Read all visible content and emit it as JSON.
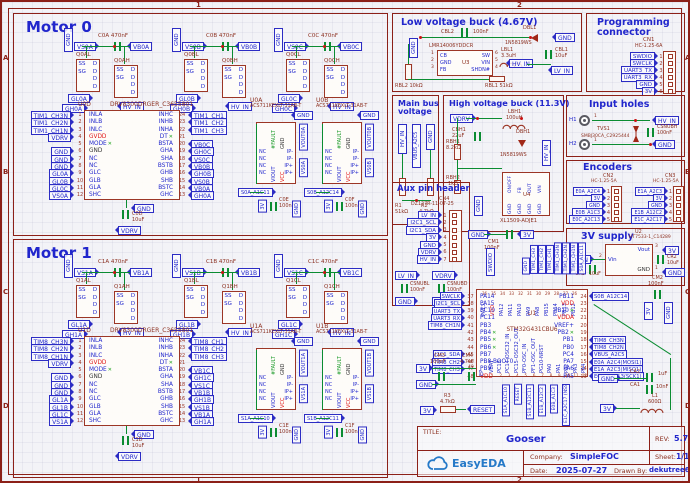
{
  "frame": {
    "rows": [
      "A",
      "B",
      "C",
      "D"
    ],
    "cols": [
      "1",
      "2"
    ]
  },
  "colors": {
    "accent_blue": "#2126cc",
    "outline_maroon": "#9c3626",
    "wire_green": "#0b8c32",
    "power_red": "#e01818",
    "logo_blue": "#2579c8"
  },
  "motor0": {
    "title": "Motor 0",
    "phases": [
      {
        "gnd": "GND",
        "vs": "VS0A",
        "cap": "C0A",
        "val": "470nF",
        "vb": "VB0A",
        "ql": "Q0AL",
        "qh": "Q0AH",
        "s": "SSSG",
        "d": "DDDD",
        "gl": "GL0A",
        "gh": "GH0A",
        "hv": "HV_IN"
      },
      {
        "gnd": "GND",
        "vs": "VS0B",
        "cap": "C0B",
        "val": "470nF",
        "vb": "VB0B",
        "ql": "Q0BL",
        "qh": "Q0BH",
        "s": "SSSG",
        "d": "DDDD",
        "gl": "GL0B",
        "gh": "GH0B",
        "hv": "HV_IN"
      },
      {
        "gnd": "GND",
        "vs": "VS0C",
        "cap": "C0C",
        "val": "470nF",
        "vb": "VB0C",
        "ql": "Q0CL",
        "qh": "Q0CH",
        "s": "SSSG",
        "d": "DDDD",
        "gl": "GL0C",
        "gh": "GH0C",
        "hv": "HV_IN"
      }
    ],
    "driver": {
      "ref": "U0D",
      "part": "DRV8300DRGER_C3655801",
      "gnd": "GND",
      "cap": "C0D",
      "capv": "10uF",
      "vdrv": "VDRV",
      "rows": [
        {
          "ln": "TIM1_CH3N",
          "lp": "1",
          "lpin": "INLA",
          "rpin": "INHC",
          "rp": "24",
          "rn": "TIM1_CH1"
        },
        {
          "ln": "TIM1_CH2N",
          "lp": "2",
          "lpin": "INLB",
          "rpin": "INHB",
          "rp": "23",
          "rn": "TIM1_CH2"
        },
        {
          "ln": "TIM1_CH1N",
          "lp": "3",
          "lpin": "INLC",
          "rpin": "INHA",
          "rp": "22",
          "rn": "TIM1_CH3"
        },
        {
          "ln": "VDRV",
          "lp": "4",
          "lpin": "GVDD",
          "lcls": "red",
          "rpin": "DT",
          "rp": "21",
          "rn": "",
          "rcls": "xm"
        },
        {
          "ln": "",
          "lp": "5",
          "lpin": "MODE",
          "lcls": "xm",
          "rpin": "BSTA",
          "rp": "20",
          "rn": "VB0C"
        },
        {
          "ln": "GND",
          "lp": "6",
          "lpin": "GND",
          "lcls": "dark",
          "rpin": "GHA",
          "rp": "19",
          "rn": "GH0C"
        },
        {
          "ln": "GND",
          "lp": "7",
          "lpin": "NC",
          "rpin": "SHA",
          "rp": "18",
          "rn": "VS0C"
        },
        {
          "ln": "GND",
          "lp": "8",
          "lpin": "NC",
          "rpin": "BSTB",
          "rp": "17",
          "rn": "VB0B"
        },
        {
          "ln": "GL0A",
          "lp": "9",
          "lpin": "GLC",
          "rpin": "GHB",
          "rp": "16",
          "rn": "GH0B"
        },
        {
          "ln": "GL0B",
          "lp": "10",
          "lpin": "GLB",
          "rpin": "SHB",
          "rp": "15",
          "rn": "VS0B"
        },
        {
          "ln": "GL0C",
          "lp": "11",
          "lpin": "GLA",
          "rpin": "BSTC",
          "rp": "14",
          "rn": "VB0A"
        },
        {
          "ln": "VS0A",
          "lp": "12",
          "lpin": "SHC",
          "rpin": "GHC",
          "rp": "13",
          "rn": "GH0A"
        }
      ]
    },
    "sensors": [
      {
        "ref": "U0A",
        "part": "ACS711KEXLT-31AB-T",
        "gnd": "GND",
        "fault": "#FAULT",
        "gndpin": "GND",
        "vout": "VOUT0A",
        "nc": [
          "NC",
          "NC",
          "NC",
          "NC"
        ],
        "ip": [
          "IP-",
          "IP-",
          "IP+",
          "IP+"
        ],
        "vs": "VS0A",
        "viout": "VIOUT",
        "vcc": "VCC",
        "snet": "S0A_A1C11",
        "cap": "C0E",
        "capv": "100nF",
        "v3": "3V",
        "gnd2": "GND"
      },
      {
        "ref": "U0B",
        "part": "ACS711KEXLT-31AB-T",
        "gnd": "GND",
        "fault": "#FAULT",
        "gndpin": "GND",
        "vout": "VOUT0B",
        "nc": [
          "NC",
          "NC",
          "NC",
          "NC"
        ],
        "ip": [
          "IP-",
          "IP-",
          "IP+",
          "IP+"
        ],
        "vs": "VS0B",
        "viout": "VIOUT",
        "vcc": "VCC",
        "snet": "S0B_A12C14",
        "cap": "C0F",
        "capv": "100nF",
        "v3": "3V",
        "gnd2": "GND"
      }
    ]
  },
  "motor1": {
    "title": "Motor 1",
    "phases": [
      {
        "gnd": "GND",
        "vs": "VS1A",
        "cap": "C1A",
        "val": "470nF",
        "vb": "VB1A",
        "ql": "Q1AL",
        "qh": "Q1AH",
        "s": "SSSG",
        "d": "DDDD",
        "gl": "GL1A",
        "gh": "GH1A",
        "hv": "HV_IN"
      },
      {
        "gnd": "GND",
        "vs": "VS1B",
        "cap": "C1B",
        "val": "470nF",
        "vb": "VB1B",
        "ql": "Q1BL",
        "qh": "Q1BH",
        "s": "SSSG",
        "d": "DDDD",
        "gl": "GL1B",
        "gh": "GH1B",
        "hv": "HV_IN"
      },
      {
        "gnd": "GND",
        "vs": "VS1C",
        "cap": "C1C",
        "val": "470nF",
        "vb": "VB1C",
        "ql": "Q1CL",
        "qh": "Q1CH",
        "s": "SSSG",
        "d": "DDDD",
        "gl": "GL1C",
        "gh": "GH1C",
        "hv": "HV_IN"
      }
    ],
    "driver": {
      "ref": "U1D",
      "part": "DRV8300DRGER_C3655801",
      "gnd": "GND",
      "cap": "C1D",
      "capv": "10uF",
      "vdrv": "VDRV",
      "rows": [
        {
          "ln": "TIM8_CH3N",
          "lp": "1",
          "lpin": "INLA",
          "rpin": "INHC",
          "rp": "24",
          "rn": "TIM8_CH1"
        },
        {
          "ln": "TIM8_CH2N",
          "lp": "2",
          "lpin": "INLB",
          "rpin": "INHB",
          "rp": "23",
          "rn": "TIM8_CH2"
        },
        {
          "ln": "TIM8_CH1N",
          "lp": "3",
          "lpin": "INLC",
          "rpin": "INHA",
          "rp": "22",
          "rn": "TIM8_CH3"
        },
        {
          "ln": "VDRV",
          "lp": "4",
          "lpin": "GVDD",
          "lcls": "red",
          "rpin": "DT",
          "rp": "21",
          "rn": "",
          "rcls": "xm"
        },
        {
          "ln": "",
          "lp": "5",
          "lpin": "MODE",
          "lcls": "xm",
          "rpin": "BSTA",
          "rp": "20",
          "rn": "VB1C"
        },
        {
          "ln": "GND",
          "lp": "6",
          "lpin": "GND",
          "lcls": "dark",
          "rpin": "GHA",
          "rp": "19",
          "rn": "GH1C"
        },
        {
          "ln": "GND",
          "lp": "7",
          "lpin": "NC",
          "rpin": "SHA",
          "rp": "18",
          "rn": "VS1C"
        },
        {
          "ln": "GND",
          "lp": "8",
          "lpin": "NC",
          "rpin": "BSTB",
          "rp": "17",
          "rn": "VB1B"
        },
        {
          "ln": "GL1A",
          "lp": "9",
          "lpin": "GLC",
          "rpin": "GHB",
          "rp": "16",
          "rn": "GH1B"
        },
        {
          "ln": "GL1B",
          "lp": "10",
          "lpin": "GLB",
          "rpin": "SHB",
          "rp": "15",
          "rn": "VS1B"
        },
        {
          "ln": "GL1C",
          "lp": "11",
          "lpin": "GLA",
          "rpin": "BSTC",
          "rp": "14",
          "rn": "VB1A"
        },
        {
          "ln": "VS1A",
          "lp": "12",
          "lpin": "SHC",
          "rpin": "GHC",
          "rp": "13",
          "rn": "GH1A"
        }
      ]
    },
    "sensors": [
      {
        "ref": "U1A",
        "part": "ACS711KEXLT-31AB-T",
        "gnd": "GND",
        "fault": "#FAULT",
        "gndpin": "GND",
        "vout": "VOUT1A",
        "nc": [
          "NC",
          "NC",
          "NC",
          "NC"
        ],
        "ip": [
          "IP-",
          "IP-",
          "IP+",
          "IP+"
        ],
        "vs": "VS1A",
        "viout": "VIOUT",
        "vcc": "VCC",
        "snet": "S1A_A1C10",
        "cap": "C1E",
        "capv": "100nF",
        "v3": "3V",
        "gnd2": "GND"
      },
      {
        "ref": "U1B",
        "part": "ACS711KEXLT-31AB-T",
        "gnd": "GND",
        "fault": "#FAULT",
        "gndpin": "GND",
        "vout": "VOUT1B",
        "nc": [
          "NC",
          "NC",
          "NC",
          "NC"
        ],
        "ip": [
          "IP-",
          "IP-",
          "IP+",
          "IP+"
        ],
        "vs": "VS1B",
        "viout": "VIOUT",
        "vcc": "VCC",
        "snet": "S1B_A12C11",
        "cap": "C1F",
        "capv": "100nF",
        "v3": "3V",
        "gnd2": "GND"
      }
    ]
  },
  "low_buck": {
    "title": "Low voltage buck (4.67V)",
    "gnd_l": "GND",
    "c2": {
      "ref": "CBL2",
      "val": "100nF"
    },
    "d1": {
      "ref": "DBL1",
      "val": "1N5819WS"
    },
    "gnd_r": "GND",
    "u": {
      "ref": "U3",
      "part": "LMR14006YDDCR",
      "lpins": [
        {
          "p": "1",
          "n": "CB"
        },
        {
          "p": "2",
          "n": "GND"
        },
        {
          "p": "3",
          "n": "FB"
        }
      ],
      "rpins": [
        {
          "n": "SW",
          "p": "6"
        },
        {
          "n": "VIN",
          "p": "5"
        },
        {
          "n": "SHDN#",
          "p": "4"
        }
      ]
    },
    "ind": {
      "ref": "LBL1",
      "val": "3.3uH"
    },
    "c1": {
      "ref": "CBL1",
      "val": "10uF"
    },
    "lv": "LV_IN",
    "hv": "HV_IN",
    "r1": {
      "ref": "RBL1",
      "val": "51kΩ"
    },
    "r2": {
      "ref": "RBL2",
      "val": "10kΩ"
    }
  },
  "prog": {
    "title1": "Programming",
    "title2": "connector",
    "ref": "CN1",
    "part": "HC-1.25-6A",
    "rows": [
      {
        "n": "SWDIO",
        "p": "1"
      },
      {
        "n": "SWCLK",
        "p": "2"
      },
      {
        "n": "UART3_TX",
        "p": "3"
      },
      {
        "n": "UART3_RX",
        "p": "4"
      },
      {
        "n": "GND",
        "p": "5"
      },
      {
        "n": "3V",
        "p": "6"
      }
    ]
  },
  "main_bus": {
    "title1": "Main bus",
    "title2": "voltage",
    "flags": [
      "HV_IN",
      "VBUS_A2C5",
      "GND"
    ],
    "r1": {
      "ref": "R1",
      "val": "51kΩ"
    },
    "r2": {
      "ref": "R2",
      "val": "4.7kΩ"
    }
  },
  "hv_buck": {
    "title": "High voltage buck (11.3V)",
    "vdrv": "VDRV",
    "ind": {
      "ref": "LBH1",
      "val": "100uH"
    },
    "cb": {
      "ref": "CBH1",
      "val": "22uF"
    },
    "d": {
      "ref": "DBH1",
      "val": "1N5819WS"
    },
    "r1": {
      "ref": "RBH1",
      "val": "8.2kΩ"
    },
    "r2": {
      "ref": "RBH2",
      "val": "1kΩ"
    },
    "hv": "HV_IN",
    "gnd": "GND",
    "u": {
      "ref": "U4",
      "part": "XL1509-ADJE1",
      "top": [
        "ON/OFF",
        "FB",
        "OUT",
        "VIN"
      ],
      "bot": [
        "GND",
        "GND",
        "GND",
        "GND"
      ]
    }
  },
  "input_holes": {
    "title": "Input holes",
    "h1": "H1",
    "h1p": "1",
    "h2": "H2",
    "h2p": "1",
    "tvs": {
      "ref": "TVS1",
      "part": "SMBJ30CA_C2925444"
    },
    "cap": {
      "ref": "CSNUBH",
      "val": "100nF"
    },
    "hv": "HV_IN",
    "gnd": "GND"
  },
  "encoders": {
    "title": "Encoders",
    "cn2": {
      "ref": "CN2",
      "part": "HC-1.25-5A",
      "rows": [
        {
          "n": "E0A_A2C4",
          "p": "1"
        },
        {
          "n": "3V",
          "p": "2"
        },
        {
          "n": "GND",
          "p": "3"
        },
        {
          "n": "E0B_A1C3",
          "p": "4"
        },
        {
          "n": "E0C_A2C13",
          "p": "5"
        }
      ]
    },
    "cn3": {
      "ref": "CN3",
      "part": "HC-1.25-5A",
      "rows": [
        {
          "n": "E1A_A2C3",
          "p": "1"
        },
        {
          "n": "3V",
          "p": "2"
        },
        {
          "n": "GND",
          "p": "3"
        },
        {
          "n": "E1B_A12C2",
          "p": "4"
        },
        {
          "n": "E1C_A2C17",
          "p": "5"
        }
      ]
    }
  },
  "aux": {
    "title": "Aux pin header",
    "ref": "CN4",
    "part": "DZ127R-11-07-25",
    "rows": [
      {
        "n": "LV_IN",
        "p": "1"
      },
      {
        "n": "I2C1_SCL",
        "p": "2"
      },
      {
        "n": "I2C1_SDA",
        "p": "3"
      },
      {
        "n": "3V",
        "p": "4"
      },
      {
        "n": "GND",
        "p": "5"
      },
      {
        "n": "VDRV",
        "p": "6"
      },
      {
        "n": "HV_IN",
        "p": "7"
      }
    ],
    "snubs": [
      {
        "net": "LV_IN",
        "ref": "CSNUBL",
        "val": "100nF",
        "gnd": "GND"
      },
      {
        "net": "VDRV",
        "ref": "CSNUBD",
        "val": "100nF",
        "gnd": "GND"
      }
    ]
  },
  "supply3v": {
    "title": "3V supply",
    "ref": "U2",
    "part": "HT7533-1_C14289",
    "vin": "Vin",
    "vin_p": "2",
    "vout": "Vout",
    "vout_p": "3",
    "gnd_pin": "GND",
    "gnd_p": "1",
    "lv": "LV_IN",
    "v3": "3V",
    "gnd": "GND",
    "cr1": {
      "ref": "CR1",
      "val": "10uF"
    },
    "cr2": {
      "ref": "CR2",
      "val": "10uF"
    }
  },
  "mcu": {
    "ref": "U1",
    "part": "STM32G431CBU6",
    "ep": "EP",
    "ep_num": "49",
    "swdio": "SWDIO",
    "decap": {
      "gnd": "GND",
      "ref": "CM1",
      "val": "100nF",
      "v3": "3V"
    },
    "top_nets": [
      "GND",
      "TIM1_CH3",
      "TIM1_CH2",
      "TIM1_CH1",
      "TIM1_CH3N",
      "TIM1_CH2N",
      "TIM1_CH1N",
      "S0A_A1C11"
    ],
    "top_pins": [
      {
        "pin": "PA13",
        "p": "36"
      },
      {
        "pin": "VDD",
        "p": "35",
        "cls": "red"
      },
      {
        "pin": "PA12",
        "p": "34"
      },
      {
        "pin": "PA11",
        "p": "33"
      },
      {
        "pin": "PA10",
        "p": "32"
      },
      {
        "pin": "PA9",
        "p": "31"
      },
      {
        "pin": "PA8",
        "p": "30"
      },
      {
        "pin": "PB15",
        "p": "29"
      },
      {
        "pin": "PB14",
        "p": "28"
      },
      {
        "pin": "PB13",
        "p": "27"
      },
      {
        "pin": "PB12",
        "p": "26"
      }
    ],
    "left": [
      {
        "ln": "SWCLK",
        "lp": "37",
        "pin": "PA14"
      },
      {
        "ln": "I2C1_SCL",
        "lp": "38",
        "pin": "PA15"
      },
      {
        "ln": "UART3_TX",
        "lp": "39",
        "pin": "PC10"
      },
      {
        "ln": "UART3_RX",
        "lp": "40",
        "pin": "PC11"
      },
      {
        "ln": "TIM8_CH1N",
        "lp": "41",
        "pin": "PB3"
      },
      {
        "ln": "",
        "lp": "42",
        "pin": "PB4",
        "cls": "xm"
      },
      {
        "ln": "",
        "lp": "43",
        "pin": "PB5",
        "cls": "xm"
      },
      {
        "ln": "",
        "lp": "44",
        "pin": "PB6",
        "cls": "xm"
      },
      {
        "ln": "I2C1_SDA",
        "lp": "45",
        "pin": "PB7"
      },
      {
        "ln": "TIM8_CH2",
        "lp": "46",
        "pin": "PB8-BOOT0"
      },
      {
        "ln": "TIM8_CH3",
        "lp": "47",
        "pin": "PB9"
      },
      {
        "ln": "",
        "lp": "48",
        "pin": "VDD",
        "cls": "red"
      }
    ],
    "right": [
      {
        "pin": "PB11",
        "p": "24",
        "n": "S0B_A12C14"
      },
      {
        "pin": "VDD",
        "p": "23",
        "n": "",
        "cls": "red"
      },
      {
        "pin": "PB10",
        "p": "22",
        "n": "",
        "cls": "xm"
      },
      {
        "pin": "VDDA",
        "p": "21",
        "n": "",
        "cls": "red"
      },
      {
        "pin": "VREF+",
        "p": "20",
        "n": ""
      },
      {
        "pin": "PB2",
        "p": "19",
        "n": "",
        "cls": "xm"
      },
      {
        "pin": "PB1",
        "p": "18",
        "n": "TIM8_CH3N"
      },
      {
        "pin": "PB0",
        "p": "17",
        "n": "TIM8_CH2N"
      },
      {
        "pin": "PC4",
        "p": "16",
        "n": "VBUS_A2C5"
      },
      {
        "pin": "PA7",
        "p": "15",
        "n": "E0A_A2C4(MOSI1)"
      },
      {
        "pin": "PA6",
        "p": "14",
        "n": "E1A_A2C3(MISO1)"
      },
      {
        "pin": "PA5",
        "p": "13",
        "n": "E0C_A2C13(SCK1)"
      }
    ],
    "bottom_pins": [
      {
        "pin": "VBAT",
        "p": "1"
      },
      {
        "pin": "PC13",
        "p": "2"
      },
      {
        "pin": "PC14-OSC32_IN",
        "p": "3"
      },
      {
        "pin": "PC15-OSC32_OUT",
        "p": "4"
      },
      {
        "pin": "PF0-OSC_IN",
        "p": "5"
      },
      {
        "pin": "PF1-OSC_OUT",
        "p": "6"
      },
      {
        "pin": "PG10-NRST",
        "p": "7"
      },
      {
        "pin": "PA0",
        "p": "8"
      },
      {
        "pin": "PA1",
        "p": "9"
      },
      {
        "pin": "PA2",
        "p": "10"
      },
      {
        "pin": "PA3",
        "p": "11"
      },
      {
        "pin": "PA4",
        "p": "12"
      }
    ],
    "bottom_nets": [
      "S1A_A1C10",
      "RESET",
      "S1B_A12C11",
      "E1B_A12C2",
      "E0B_A1C3",
      "E1C_A2C17 (NSS1)"
    ],
    "c3": {
      "ref": "CM3",
      "val": "100nF"
    },
    "c4": {
      "ref": "CM4",
      "val": "4.7uF"
    },
    "v3a": "3V",
    "gnda": "GND",
    "r3": {
      "ref": "R3",
      "val": "4.7kΩ",
      "v3": "3V",
      "reset": "RESET"
    },
    "c2": {
      "ref": "CM2",
      "val": "100nF",
      "v3": "3V",
      "gnd": "GND"
    },
    "ca": {
      "gnd": "GND",
      "ca2": "CA2",
      "ca2v": "1uF",
      "ca1": "CA1",
      "ca1v": "10nF"
    },
    "l1": {
      "ref": "L1",
      "val": "600Ω",
      "v3": "3V"
    }
  },
  "titleblock": {
    "title_label": "TITLE:",
    "title": "Gooser",
    "rev_label": "REV:",
    "rev": "5.7",
    "company_label": "Company:",
    "company": "SimpleFOC",
    "sheet_label": "Sheet:",
    "sheet": "1/1",
    "date_label": "Date:",
    "date": "2025-07-27",
    "drawn_label": "Drawn By:",
    "drawn": "dekutree64",
    "logo": "EasyEDA"
  }
}
